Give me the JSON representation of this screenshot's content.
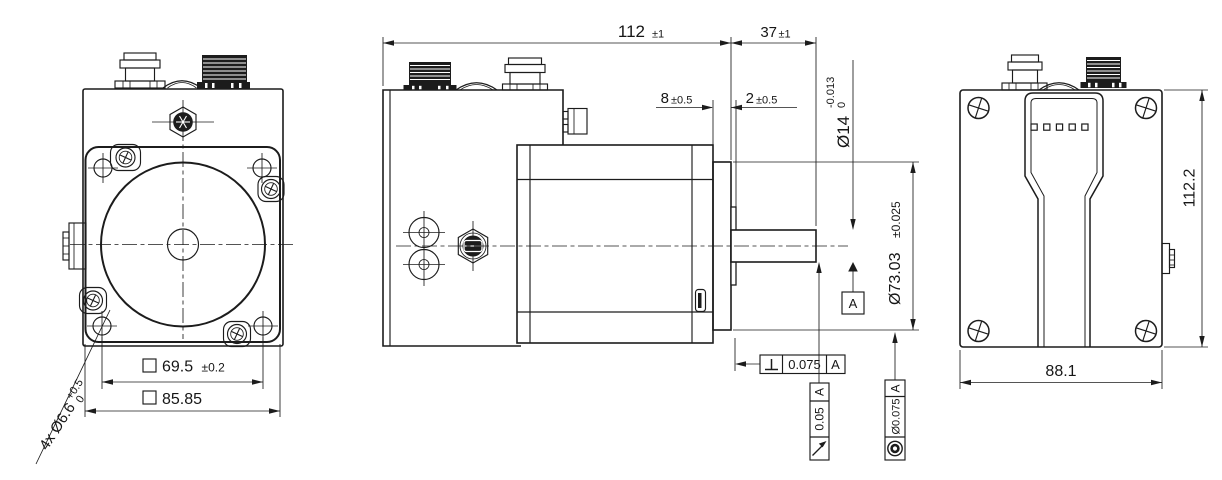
{
  "page": {
    "background": "#ffffff",
    "line_color": "#1c1c1c"
  },
  "symbols": {
    "diameter": "Ø",
    "square": "□",
    "plus_minus": "±",
    "perpendicularity": "⊥",
    "circular_runout": "↗",
    "concentricity": "◎",
    "datum": "A"
  },
  "front_view": {
    "mounting_holes_note": {
      "label": "4x Ø6.6",
      "tol_upper": "+0.5",
      "tol_lower": "0"
    },
    "bolt_circle_dim": {
      "value": "69.5",
      "tol": "±0.2"
    },
    "flange_dim": {
      "value": "85.85"
    }
  },
  "side_view": {
    "overall_length_dim": {
      "value": "112",
      "tol": "±1"
    },
    "shaft_end_dim": {
      "value": "37",
      "tol": "±1"
    },
    "pilot_depth_dim": {
      "value": "8",
      "tol": "±0.5"
    },
    "spacer_dim": {
      "value": "2",
      "tol": "±0.5"
    },
    "shaft_dia_dim": {
      "value": "Ø14",
      "tol_upper": "0",
      "tol_lower": "-0.013"
    },
    "pilot_dia_dim": {
      "value": "Ø73.03",
      "tol": "±0.025"
    },
    "perpendicularity_frame": {
      "tolerance": "0.075",
      "datum": "A"
    },
    "runout_frame": {
      "tolerance": "0.05",
      "datum": "A"
    },
    "concentricity_frame": {
      "tolerance": "Ø0.075",
      "datum": "A"
    },
    "datum_flag": {
      "label": "A"
    }
  },
  "back_view": {
    "height_dim": {
      "value": "112.2"
    },
    "width_dim": {
      "value": "88.1"
    }
  }
}
